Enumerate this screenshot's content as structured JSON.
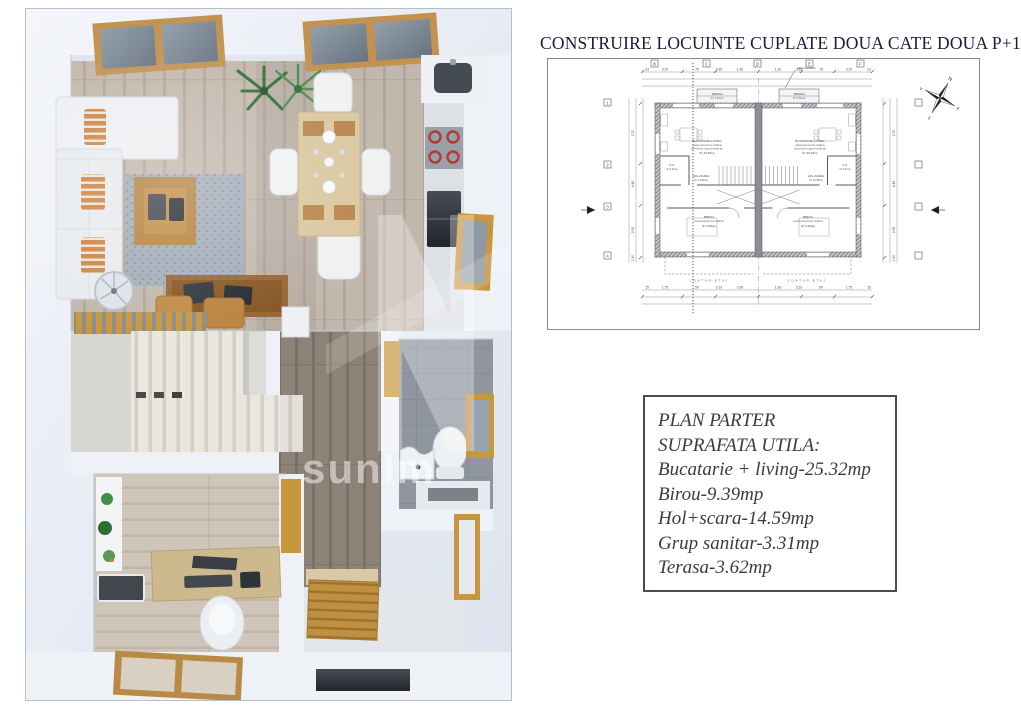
{
  "title": {
    "text": "CONSTRUIRE LOCUINTE CUPLATE DOUA CATE DOUA P+1E+M",
    "color": "#1a1a3e"
  },
  "info_box": {
    "border_color": "#4b4c52",
    "text_color": "#3a3a45",
    "lines": [
      "PLAN PARTER",
      "SUPRAFATA UTILA:",
      "Bucatarie + living-25.32mp",
      "Birou-9.39mp",
      "Hol+scara-14.59mp",
      "Grup sanitar-3.31mp",
      "Terasa-3.62mp"
    ]
  },
  "watermark": {
    "fragment": "sunIm"
  },
  "blueprint": {
    "line_color": "#55575b",
    "note": "tabla metalica",
    "compass": {
      "n": "N",
      "e": "E",
      "s": "S",
      "v": "V"
    },
    "contur_label": "CONTUR ETAJ",
    "rooms": {
      "terasa": {
        "name": "TERASA",
        "area": "S= 3.62mp"
      },
      "living": {
        "name": "BUCATARIE+LIVING",
        "detail1": "pardoseala parchet stratificat",
        "detail2": "pereti-tavan zugravit lavabil alb",
        "area": "S= 25.32mp"
      },
      "hol": {
        "name": "HOL+SCARA",
        "area": "S= 14.59mp"
      },
      "gs": {
        "name": "G.S.",
        "area": "S= 3.31mp"
      },
      "birou": {
        "name": "BIROU",
        "detail1": "pardoseala parchet stratificat",
        "area": "S= 9.39mp"
      }
    },
    "dims_top": [
      "23",
      "3.20",
      "75",
      "3.35",
      "1.20",
      "1.20",
      "3.35",
      "75",
      "3.20",
      "23"
    ],
    "dims_bottom": [
      "15",
      "1.75",
      "50",
      "3.10",
      "1.60",
      "1.60",
      "3.10",
      "50",
      "1.75",
      "15"
    ],
    "dims_left": [
      "2.70",
      "4.45",
      "2.55",
      "1.50"
    ],
    "dims_right": [
      "2.70",
      "4.45",
      "2.55",
      "1.50"
    ],
    "grid_top": [
      "B",
      "C",
      "D",
      "E",
      "F"
    ],
    "grid_left": [
      "1",
      "2",
      "3",
      "4"
    ]
  },
  "palette": {
    "wood_frame": "#c8963f",
    "floor_living": "#c2b7ac",
    "floor_hall": "#8d8277",
    "floor_office": "#cfc5b9",
    "bath_tile": "#8f969f",
    "wall": "#e9edf3",
    "stove_burner": "#b33a31",
    "plant_green": "#3a7d40"
  }
}
